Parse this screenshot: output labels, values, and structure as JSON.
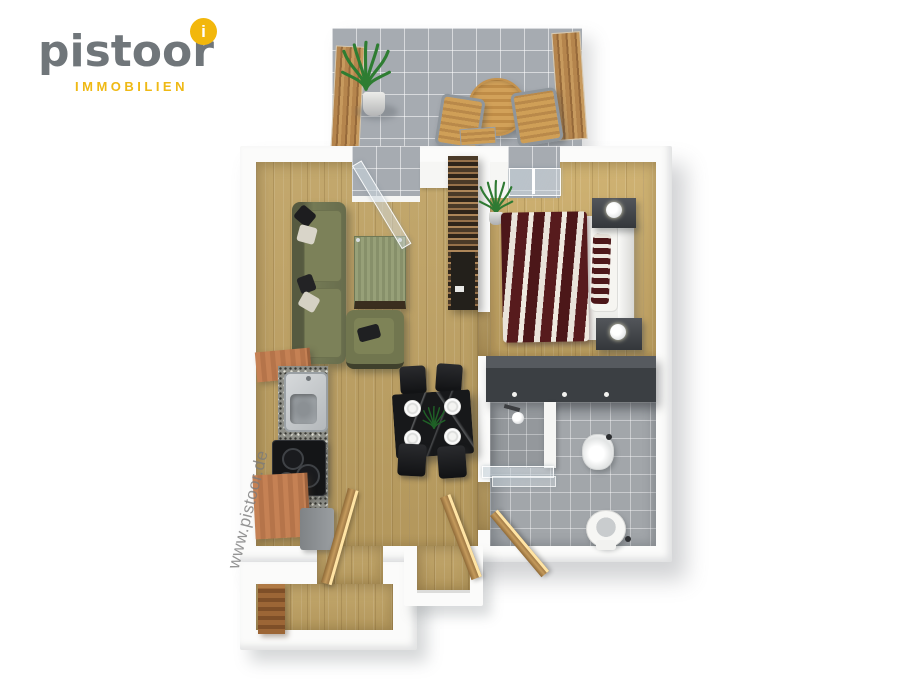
{
  "logo": {
    "brand": "pistoor",
    "subtitle": "IMMOBILIEN",
    "badge_letter": "i"
  },
  "watermark": {
    "text": "www.pistoor.de"
  },
  "scene": {
    "type": "3d-floor-plan-rendering",
    "rooms": [
      "balcony",
      "living-room",
      "bedroom",
      "kitchen",
      "dining-area",
      "bathroom",
      "hallway",
      "entrance"
    ]
  },
  "colors": {
    "background": "#ffffff",
    "brand_gray": "#70767a",
    "brand_gold": "#f2b70c",
    "wall_white": "#f6f6f4",
    "wood_floor": "#bda368",
    "balcony_tile": "#a6abb1",
    "bathroom_tile": "#a2a6aa",
    "sofa_green": "#6f744f",
    "bed_stripe_red": "#4c1719",
    "wardrobe_gray": "#3b3f43",
    "kitchen_terracotta": "#c3805a",
    "door_wood": "#c49a5c",
    "dining_table_black": "#17181a"
  }
}
